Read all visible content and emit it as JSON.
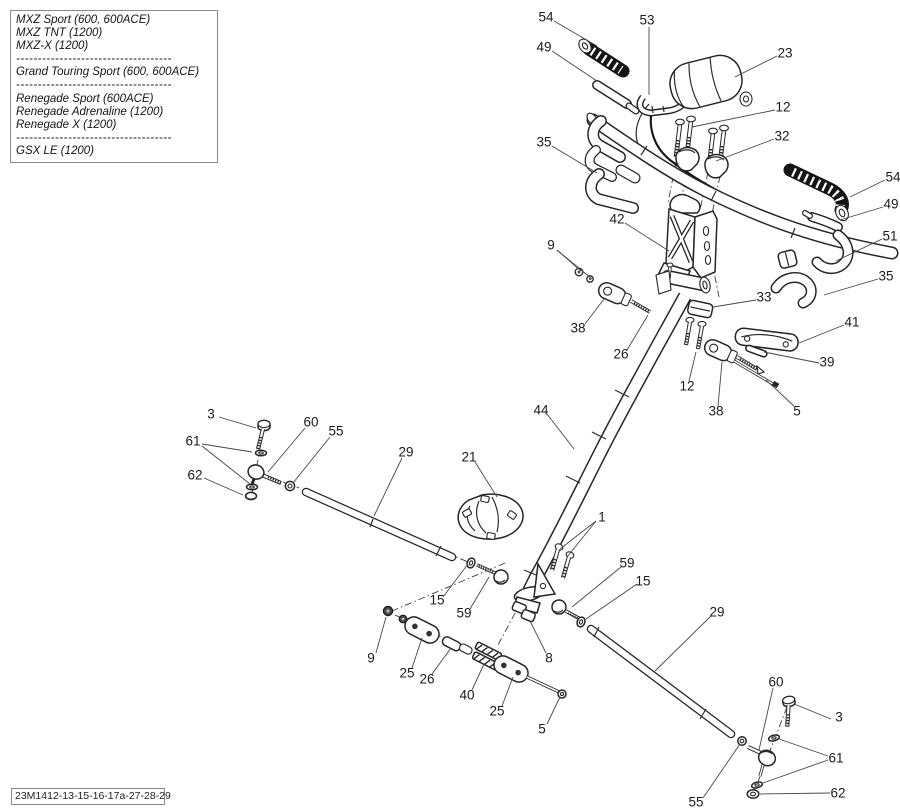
{
  "legend": {
    "separator": "------------------------------------",
    "groups": [
      [
        "MXZ Sport (600, 600ACE)",
        "MXZ TNT (1200)",
        "MXZ-X (1200)"
      ],
      [
        "Grand Touring Sport (600, 600ACE)"
      ],
      [
        "Renegade Sport (600ACE)",
        "Renegade Adrenaline (1200)",
        "Renegade X (1200)"
      ],
      [
        "GSX LE (1200)"
      ]
    ]
  },
  "footer": {
    "code": "23M1412-13-15-16-17a-27-28-29"
  },
  "colors": {
    "ink": "#262626",
    "paper": "#ffffff",
    "grip": "#141414",
    "label": "#1b1b1b"
  },
  "diagram": {
    "description": "Exploded parts view of snowmobile steering system (handlebar, riser, steering column, tie rods)",
    "callouts": [
      {
        "label": "54",
        "x": 546,
        "y": 17,
        "leaders": [
          [
            554,
            21,
            597,
            46
          ]
        ]
      },
      {
        "label": "53",
        "x": 647,
        "y": 20,
        "leaders": [
          [
            649,
            27,
            649,
            95
          ]
        ]
      },
      {
        "label": "49",
        "x": 544,
        "y": 47,
        "leaders": [
          [
            552,
            51,
            597,
            81
          ]
        ]
      },
      {
        "label": "23",
        "x": 785,
        "y": 53,
        "leaders": [
          [
            777,
            56,
            735,
            77
          ]
        ]
      },
      {
        "label": "12",
        "x": 783,
        "y": 107,
        "leaders": [
          [
            775,
            110,
            692,
            127
          ]
        ]
      },
      {
        "label": "32",
        "x": 782,
        "y": 136,
        "leaders": [
          [
            774,
            139,
            716,
            161
          ]
        ]
      },
      {
        "label": "35",
        "x": 544,
        "y": 142,
        "leaders": [
          [
            552,
            146,
            597,
            173
          ]
        ]
      },
      {
        "label": "54",
        "x": 893,
        "y": 177,
        "leaders": [
          [
            885,
            180,
            850,
            197
          ]
        ]
      },
      {
        "label": "49",
        "x": 891,
        "y": 204,
        "leaders": [
          [
            883,
            207,
            840,
            220
          ]
        ]
      },
      {
        "label": "51",
        "x": 890,
        "y": 236,
        "leaders": [
          [
            882,
            239,
            836,
            261
          ]
        ]
      },
      {
        "label": "35",
        "x": 886,
        "y": 276,
        "leaders": [
          [
            878,
            279,
            824,
            295
          ]
        ]
      },
      {
        "label": "42",
        "x": 617,
        "y": 219,
        "leaders": [
          [
            625,
            223,
            669,
            251
          ]
        ]
      },
      {
        "label": "9",
        "x": 551,
        "y": 245,
        "leaders": [
          [
            557,
            250,
            581,
            271
          ],
          [
            557,
            250,
            592,
            279
          ]
        ]
      },
      {
        "label": "33",
        "x": 764,
        "y": 297,
        "leaders": [
          [
            756,
            300,
            713,
            307
          ]
        ]
      },
      {
        "label": "38",
        "x": 578,
        "y": 328,
        "leaders": [
          [
            585,
            324,
            604,
            299
          ]
        ]
      },
      {
        "label": "26",
        "x": 621,
        "y": 354,
        "leaders": [
          [
            627,
            350,
            648,
            315
          ]
        ]
      },
      {
        "label": "41",
        "x": 852,
        "y": 322,
        "leaders": [
          [
            844,
            325,
            799,
            343
          ]
        ]
      },
      {
        "label": "39",
        "x": 827,
        "y": 362,
        "leaders": [
          [
            819,
            363,
            764,
            352
          ]
        ]
      },
      {
        "label": "12",
        "x": 687,
        "y": 386,
        "leaders": [
          [
            689,
            381,
            696,
            352
          ]
        ]
      },
      {
        "label": "38",
        "x": 716,
        "y": 411,
        "leaders": [
          [
            718,
            406,
            722,
            362
          ]
        ]
      },
      {
        "label": "5",
        "x": 797,
        "y": 411,
        "leaders": [
          [
            794,
            406,
            766,
            380
          ]
        ]
      },
      {
        "label": "44",
        "x": 541,
        "y": 410,
        "leaders": [
          [
            547,
            414,
            574,
            449
          ]
        ]
      },
      {
        "label": "3",
        "x": 211,
        "y": 414,
        "leaders": [
          [
            219,
            417,
            256,
            428
          ]
        ]
      },
      {
        "label": "60",
        "x": 311,
        "y": 422,
        "leaders": [
          [
            305,
            428,
            268,
            472
          ]
        ]
      },
      {
        "label": "55",
        "x": 336,
        "y": 431,
        "leaders": [
          [
            330,
            437,
            293,
            483
          ]
        ]
      },
      {
        "label": "61",
        "x": 193,
        "y": 441,
        "leaders": [
          [
            202,
            444,
            252,
            452
          ],
          [
            202,
            446,
            250,
            484
          ]
        ]
      },
      {
        "label": "62",
        "x": 195,
        "y": 475,
        "leaders": [
          [
            204,
            478,
            243,
            495
          ]
        ]
      },
      {
        "label": "29",
        "x": 406,
        "y": 452,
        "leaders": [
          [
            402,
            458,
            374,
            516
          ]
        ]
      },
      {
        "label": "21",
        "x": 469,
        "y": 457,
        "leaders": [
          [
            475,
            462,
            497,
            497
          ]
        ]
      },
      {
        "label": "1",
        "x": 602,
        "y": 517,
        "leaders": [
          [
            596,
            521,
            560,
            549
          ],
          [
            596,
            521,
            567,
            557
          ]
        ]
      },
      {
        "label": "59",
        "x": 627,
        "y": 563,
        "leaders": [
          [
            621,
            567,
            572,
            607
          ]
        ]
      },
      {
        "label": "15",
        "x": 643,
        "y": 581,
        "leaders": [
          [
            637,
            584,
            586,
            619
          ]
        ]
      },
      {
        "label": "15",
        "x": 437,
        "y": 600,
        "leaders": [
          [
            443,
            597,
            468,
            564
          ]
        ]
      },
      {
        "label": "59",
        "x": 464,
        "y": 613,
        "leaders": [
          [
            470,
            609,
            489,
            577
          ]
        ]
      },
      {
        "label": "29",
        "x": 717,
        "y": 612,
        "leaders": [
          [
            711,
            616,
            655,
            671
          ]
        ]
      },
      {
        "label": "8",
        "x": 549,
        "y": 658,
        "leaders": [
          [
            546,
            653,
            530,
            621
          ]
        ]
      },
      {
        "label": "9",
        "x": 371,
        "y": 658,
        "leaders": [
          [
            376,
            653,
            386,
            617
          ]
        ]
      },
      {
        "label": "25",
        "x": 407,
        "y": 673,
        "leaders": [
          [
            412,
            668,
            422,
            638
          ]
        ]
      },
      {
        "label": "26",
        "x": 427,
        "y": 679,
        "leaders": [
          [
            432,
            674,
            451,
            648
          ]
        ]
      },
      {
        "label": "40",
        "x": 467,
        "y": 695,
        "leaders": [
          [
            472,
            690,
            484,
            664
          ]
        ]
      },
      {
        "label": "25",
        "x": 497,
        "y": 711,
        "leaders": [
          [
            502,
            706,
            513,
            677
          ]
        ]
      },
      {
        "label": "5",
        "x": 542,
        "y": 729,
        "leaders": [
          [
            547,
            724,
            560,
            697
          ]
        ]
      },
      {
        "label": "60",
        "x": 776,
        "y": 682,
        "leaders": [
          [
            773,
            688,
            759,
            750
          ]
        ]
      },
      {
        "label": "3",
        "x": 839,
        "y": 717,
        "leaders": [
          [
            831,
            719,
            794,
            704
          ]
        ]
      },
      {
        "label": "61",
        "x": 836,
        "y": 758,
        "leaders": [
          [
            828,
            756,
            779,
            739
          ],
          [
            828,
            760,
            763,
            783
          ]
        ]
      },
      {
        "label": "55",
        "x": 696,
        "y": 802,
        "leaders": [
          [
            703,
            798,
            740,
            744
          ]
        ]
      },
      {
        "label": "62",
        "x": 838,
        "y": 793,
        "leaders": [
          [
            830,
            793,
            760,
            794
          ]
        ]
      }
    ]
  }
}
